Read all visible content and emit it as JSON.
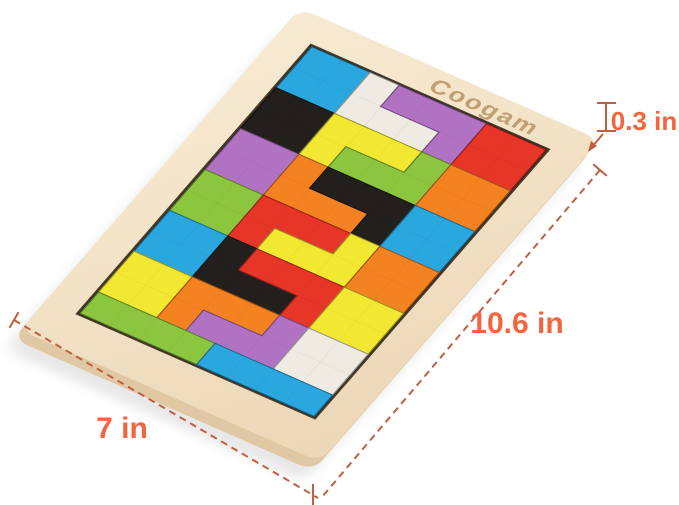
{
  "product": {
    "brand": "Coogam",
    "type": "wooden tetris puzzle board"
  },
  "annotations": {
    "width_label": "7 in",
    "height_label": "10.6 in",
    "thickness_label": "0.3 in",
    "label_color": "#f2653d",
    "line_color": "#c05f3f"
  },
  "board": {
    "wood_color_light": "#f8ebd3",
    "wood_color_dark": "#ecd7b6",
    "wood_side_color": "#e0c8a4",
    "brand_engrave_color": "#bf9c6f",
    "base_color": "#26211c",
    "grid": {
      "cols": 8,
      "rows": 13
    },
    "cell_size": 33,
    "inner_origin": {
      "x": 38,
      "y": 40
    },
    "palette": {
      "cyan": "#2aa7df",
      "green": "#8cc63f",
      "yellow": "#f2e832",
      "orange": "#f58220",
      "red": "#e73528",
      "purple": "#b272c4",
      "black": "#221f1d",
      "white": "#efebe2"
    },
    "pieces": [
      {
        "color": "cyan",
        "shape": "O",
        "cells": [
          [
            0,
            0
          ],
          [
            1,
            0
          ],
          [
            0,
            1
          ],
          [
            1,
            1
          ]
        ]
      },
      {
        "color": "white",
        "shape": "J",
        "cells": [
          [
            2,
            0
          ],
          [
            2,
            1
          ],
          [
            3,
            1
          ],
          [
            4,
            1
          ]
        ]
      },
      {
        "color": "purple",
        "shape": "L",
        "cells": [
          [
            3,
            0
          ],
          [
            4,
            0
          ],
          [
            5,
            0
          ],
          [
            5,
            1
          ]
        ]
      },
      {
        "color": "red",
        "shape": "O",
        "cells": [
          [
            6,
            0
          ],
          [
            7,
            0
          ],
          [
            6,
            1
          ],
          [
            7,
            1
          ]
        ]
      },
      {
        "color": "black",
        "shape": "O",
        "cells": [
          [
            0,
            2
          ],
          [
            1,
            2
          ],
          [
            0,
            3
          ],
          [
            1,
            3
          ]
        ]
      },
      {
        "color": "yellow",
        "shape": "J",
        "cells": [
          [
            2,
            2
          ],
          [
            3,
            2
          ],
          [
            4,
            2
          ],
          [
            2,
            3
          ]
        ]
      },
      {
        "color": "green",
        "shape": "L",
        "cells": [
          [
            5,
            2
          ],
          [
            5,
            3
          ],
          [
            4,
            3
          ],
          [
            3,
            3
          ]
        ]
      },
      {
        "color": "orange",
        "shape": "O",
        "cells": [
          [
            6,
            2
          ],
          [
            7,
            2
          ],
          [
            6,
            3
          ],
          [
            7,
            3
          ]
        ]
      },
      {
        "color": "purple",
        "shape": "O",
        "cells": [
          [
            0,
            4
          ],
          [
            1,
            4
          ],
          [
            0,
            5
          ],
          [
            1,
            5
          ]
        ]
      },
      {
        "color": "orange",
        "shape": "J",
        "cells": [
          [
            2,
            4
          ],
          [
            2,
            5
          ],
          [
            3,
            5
          ],
          [
            4,
            5
          ]
        ]
      },
      {
        "color": "black",
        "shape": "L",
        "cells": [
          [
            3,
            4
          ],
          [
            4,
            4
          ],
          [
            5,
            4
          ],
          [
            5,
            5
          ]
        ]
      },
      {
        "color": "cyan",
        "shape": "O",
        "cells": [
          [
            6,
            4
          ],
          [
            7,
            4
          ],
          [
            6,
            5
          ],
          [
            7,
            5
          ]
        ]
      },
      {
        "color": "green",
        "shape": "O",
        "cells": [
          [
            0,
            6
          ],
          [
            1,
            6
          ],
          [
            0,
            7
          ],
          [
            1,
            7
          ]
        ]
      },
      {
        "color": "red",
        "shape": "J",
        "cells": [
          [
            2,
            6
          ],
          [
            3,
            6
          ],
          [
            4,
            6
          ],
          [
            2,
            7
          ]
        ]
      },
      {
        "color": "yellow",
        "shape": "L",
        "cells": [
          [
            5,
            6
          ],
          [
            5,
            7
          ],
          [
            4,
            7
          ],
          [
            3,
            7
          ]
        ]
      },
      {
        "color": "orange",
        "shape": "O",
        "cells": [
          [
            6,
            6
          ],
          [
            7,
            6
          ],
          [
            6,
            7
          ],
          [
            7,
            7
          ]
        ]
      },
      {
        "color": "cyan",
        "shape": "O",
        "cells": [
          [
            0,
            8
          ],
          [
            1,
            8
          ],
          [
            0,
            9
          ],
          [
            1,
            9
          ]
        ]
      },
      {
        "color": "black",
        "shape": "J",
        "cells": [
          [
            2,
            8
          ],
          [
            2,
            9
          ],
          [
            3,
            9
          ],
          [
            4,
            9
          ]
        ]
      },
      {
        "color": "red",
        "shape": "L",
        "cells": [
          [
            3,
            8
          ],
          [
            4,
            8
          ],
          [
            5,
            8
          ],
          [
            5,
            9
          ]
        ]
      },
      {
        "color": "yellow",
        "shape": "O",
        "cells": [
          [
            6,
            8
          ],
          [
            7,
            8
          ],
          [
            6,
            9
          ],
          [
            7,
            9
          ]
        ]
      },
      {
        "color": "yellow",
        "shape": "O",
        "cells": [
          [
            0,
            10
          ],
          [
            1,
            10
          ],
          [
            0,
            11
          ],
          [
            1,
            11
          ]
        ]
      },
      {
        "color": "orange",
        "shape": "J",
        "cells": [
          [
            2,
            10
          ],
          [
            3,
            10
          ],
          [
            4,
            10
          ],
          [
            2,
            11
          ]
        ]
      },
      {
        "color": "purple",
        "shape": "L",
        "cells": [
          [
            5,
            10
          ],
          [
            5,
            11
          ],
          [
            4,
            11
          ],
          [
            3,
            11
          ]
        ]
      },
      {
        "color": "white",
        "shape": "O",
        "cells": [
          [
            6,
            10
          ],
          [
            7,
            10
          ],
          [
            6,
            11
          ],
          [
            7,
            11
          ]
        ]
      },
      {
        "color": "green",
        "shape": "I",
        "cells": [
          [
            0,
            12
          ],
          [
            1,
            12
          ],
          [
            2,
            12
          ],
          [
            3,
            12
          ]
        ]
      },
      {
        "color": "cyan",
        "shape": "I",
        "cells": [
          [
            4,
            12
          ],
          [
            5,
            12
          ],
          [
            6,
            12
          ],
          [
            7,
            12
          ]
        ]
      }
    ]
  }
}
